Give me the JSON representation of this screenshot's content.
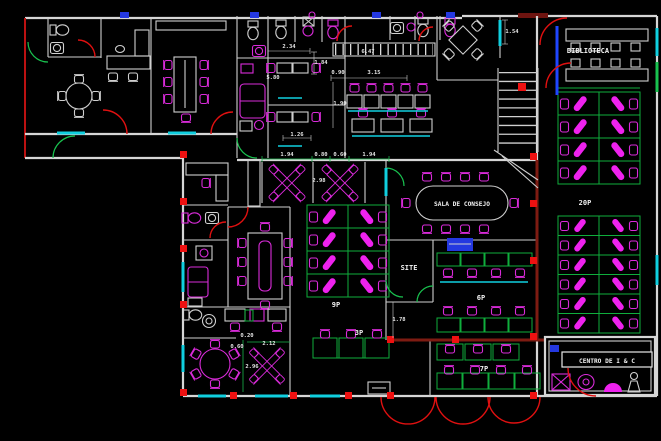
{
  "drawing": {
    "rooms": {
      "biblioteca": "BIBLIOTECA",
      "sala_de_consejo": "SALA DE CONSEJO",
      "site": "SITE",
      "centro": "CENTRO DE I & C"
    },
    "capacities": {
      "right_wing": "20P",
      "center_bank": "9P",
      "training": "6P",
      "small_row": "3P",
      "lower_room": "7P"
    },
    "dimensions": {
      "d_2_34": "2.34",
      "d_1_84": "1.84",
      "d_5_80": "5.80",
      "d_1_26": "1.26",
      "d_6_47": "6.47",
      "d_0_90": "0.90",
      "d_3_15": "3.15",
      "d_1_90": "1.90",
      "d_1_54": "1.54",
      "d_1_94_left": "1.94",
      "d_0_80": "0.80",
      "d_0_60_top": "0.60",
      "d_1_94_right": "1.94",
      "d_2_98": "2.98",
      "d_0_20": "0.20",
      "d_0_60_bottom": "0.60",
      "d_2_12": "2.12",
      "d_2_96": "2.96",
      "d_1_78": "1.78"
    },
    "colors": {
      "background": "#000000",
      "walls": "#d6d6d6",
      "furniture": "#d92bd9",
      "furniture_fill": "#ee22ee",
      "cubicles": "#0fae3c",
      "doors": "#e01010",
      "maroon_walls": "#7e1b12",
      "accent_cyan": "#10cfdf",
      "accent_blue": "#2438e0",
      "columns": "#ee1111",
      "text": "#f2f2f2"
    }
  }
}
